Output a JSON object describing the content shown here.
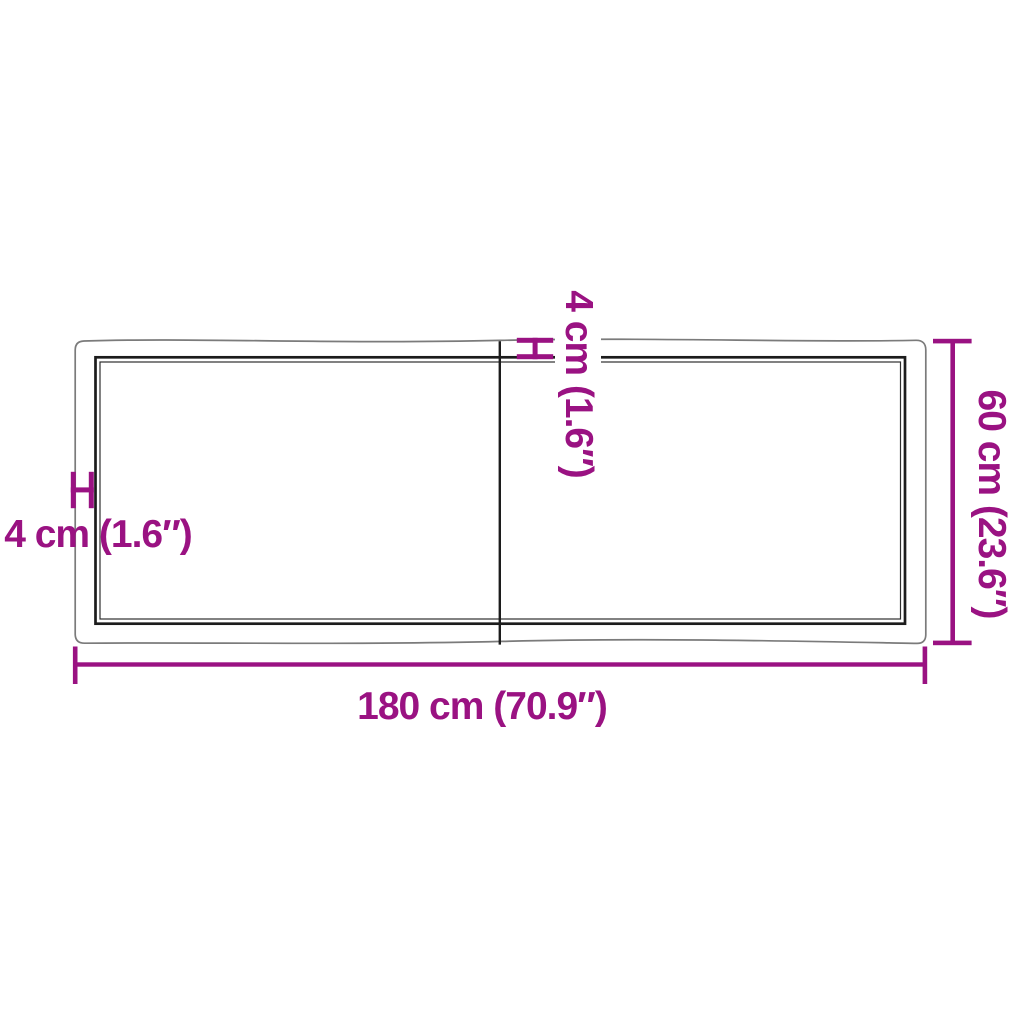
{
  "page": {
    "background": "#ffffff"
  },
  "colors": {
    "accent_magenta": "#9A1282",
    "live_edge_gray": "#7b7b7b",
    "surface_black": "#1c1c1c"
  },
  "diagram": {
    "kind": "tabletop-dimension-diagram",
    "labels": {
      "width": "180 cm (70.9″)",
      "depth": "60 cm (23.6″)",
      "thickness_side": "4 cm (1.6″)",
      "thickness_top": "4 cm (1.6″)"
    }
  }
}
